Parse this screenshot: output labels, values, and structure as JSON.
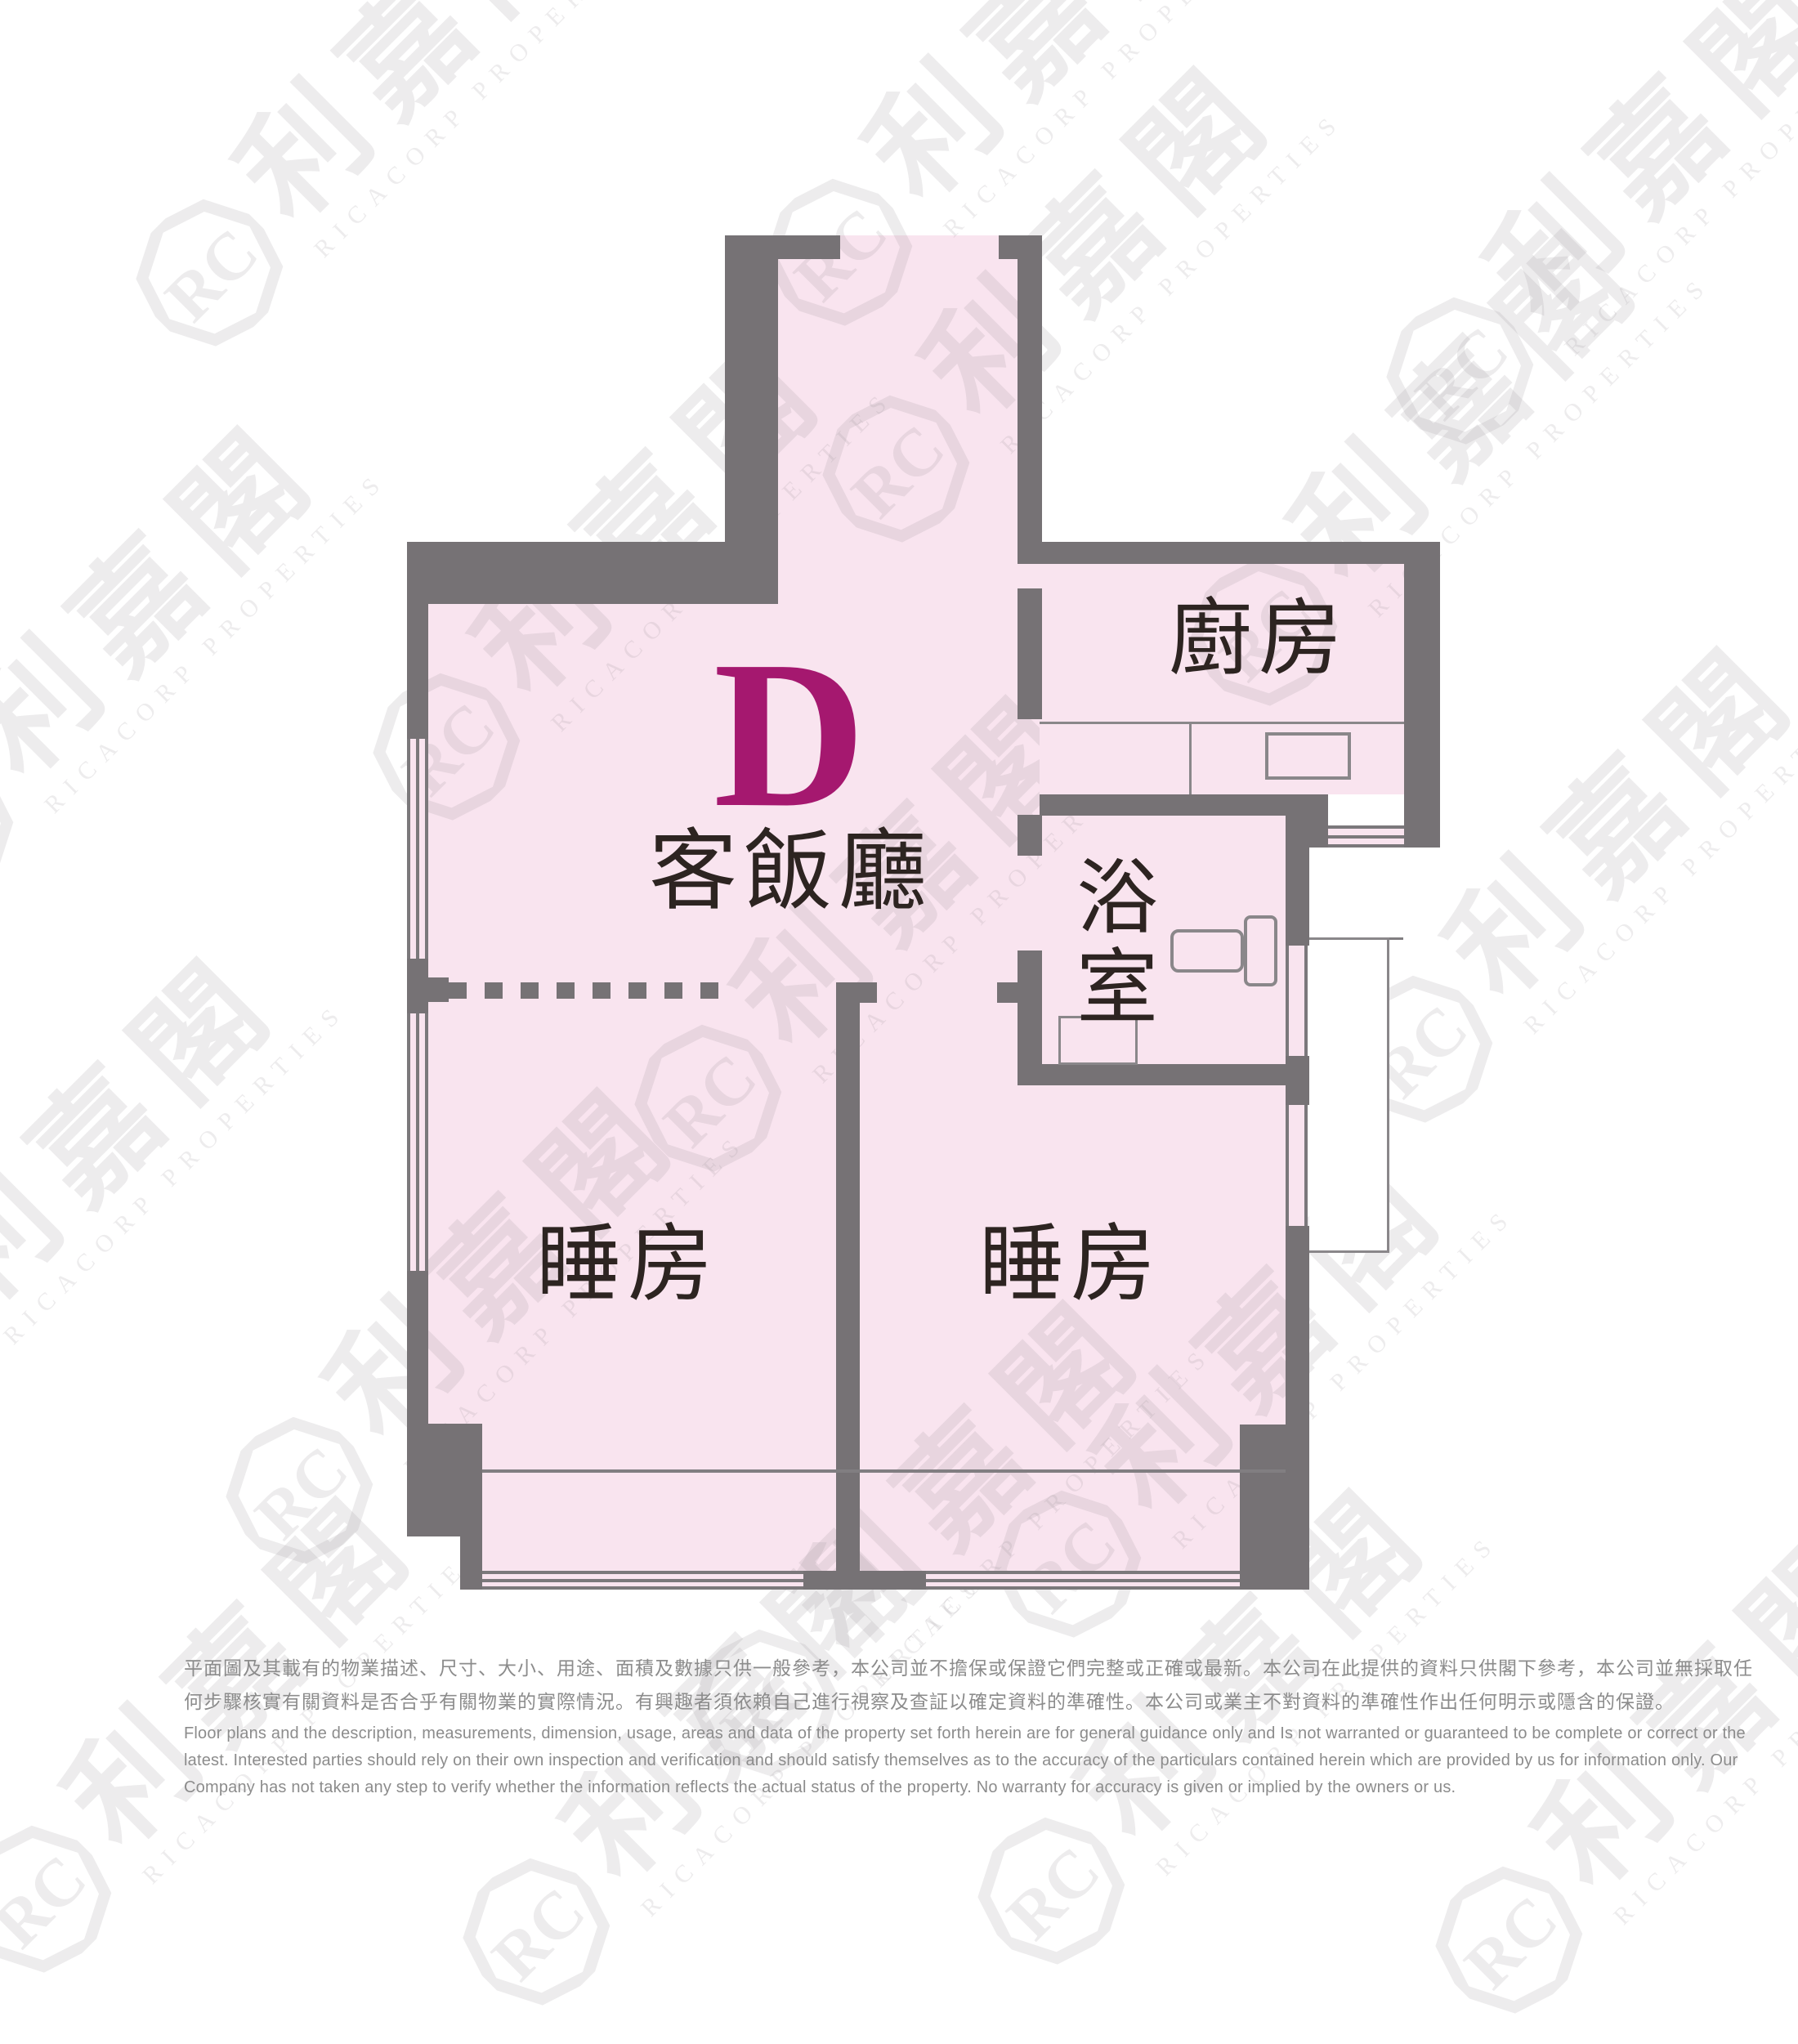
{
  "floor_plan": {
    "unit_label": "D",
    "rooms": {
      "living_dining": "客飯廳",
      "kitchen": "廚房",
      "bathroom": "浴室",
      "bedroom_left": "睡房",
      "bedroom_right": "睡房"
    },
    "colors": {
      "room_fill": "#f9e4ef",
      "wall": "#767275",
      "unit_accent": "#a5186f",
      "room_label_text": "#2d2421",
      "disclaimer_text": "#8c8c8c"
    }
  },
  "watermark": {
    "brand_cjk": "利嘉閣",
    "brand_en": "RICACORP PROPERTIES",
    "monogram": "RC"
  },
  "disclaimer": {
    "zh_lines": [
      "平面圖及其載有的物業描述、尺寸、大小、用途、面積及數據只供一般參考，本公司並不擔保或保證它們完整或正確或最新。本公司在此提供的資料只供閣下參考，本公司並無採取任",
      "何步驟核實有關資料是否合乎有關物業的實際情況。有興趣者須依賴自己進行視察及查証以確定資料的準確性。本公司或業主不對資料的準確性作出任何明示或隱含的保證。"
    ],
    "en_lines": [
      "Floor plans and the description, measurements, dimension, usage, areas and data of the property set forth herein are for general guidance only and Is not warranted or guaranteed to be complete or correct or the",
      "latest. Interested parties should rely on their own inspection and verification and should satisfy themselves as to the accuracy of the particulars contained herein which are provided by us for information only.  Our",
      "Company has not taken any step to verify whether the information reflects the actual status of the property.  No warranty for accuracy is given or implied by the owners or us."
    ]
  }
}
